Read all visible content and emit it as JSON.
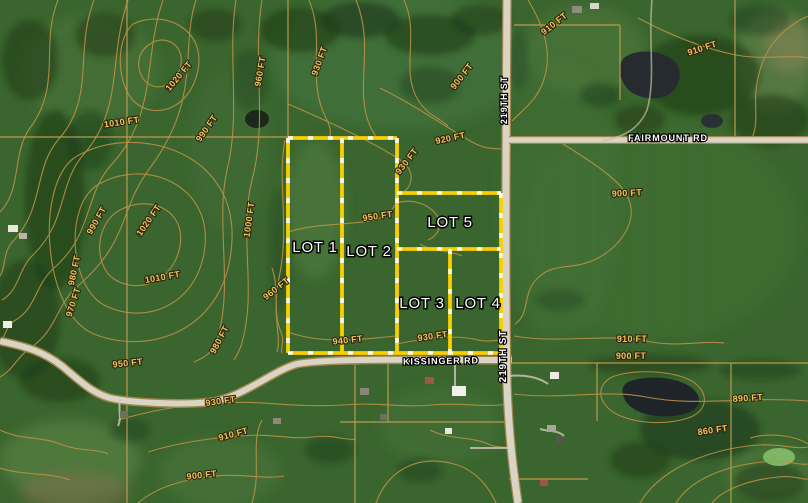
{
  "map": {
    "type": "aerial-parcel-map",
    "lot_labels": [
      "LOT 1",
      "LOT 2",
      "LOT 3",
      "LOT 4",
      "LOT 5"
    ],
    "road_labels": {
      "st219": "219TH ST",
      "fairmount": "FAIRMOUNT RD",
      "kissinger": "KISSINGER RD"
    },
    "contour_labels": [
      "1020 FT",
      "1010 FT",
      "990 FT",
      "960 FT",
      "930 FT",
      "910 FT",
      "900 FT",
      "910 FT",
      "920 FT",
      "930 FT",
      "950 FT",
      "990 FT",
      "1020 FT",
      "1000 FT",
      "1010 FT",
      "980 FT",
      "970 FT",
      "960 FT",
      "980 FT",
      "950 FT",
      "940 FT",
      "930 FT",
      "930 FT",
      "910 FT",
      "900 FT",
      "910 FT",
      "900 FT",
      "900 FT",
      "890 FT",
      "860 FT"
    ],
    "colors": {
      "lot_boundary_yellow": "#f9cf00",
      "boundary_dash_white": "#ffffff",
      "contour_line_tan": "#bb9247",
      "contour_label_gold": "#ecc65c",
      "road_fill_gray": "#d9d4c6",
      "road_label_white": "#ffffff",
      "field_green_base": "#3a652e",
      "pond_dark": "#232a2d"
    }
  }
}
